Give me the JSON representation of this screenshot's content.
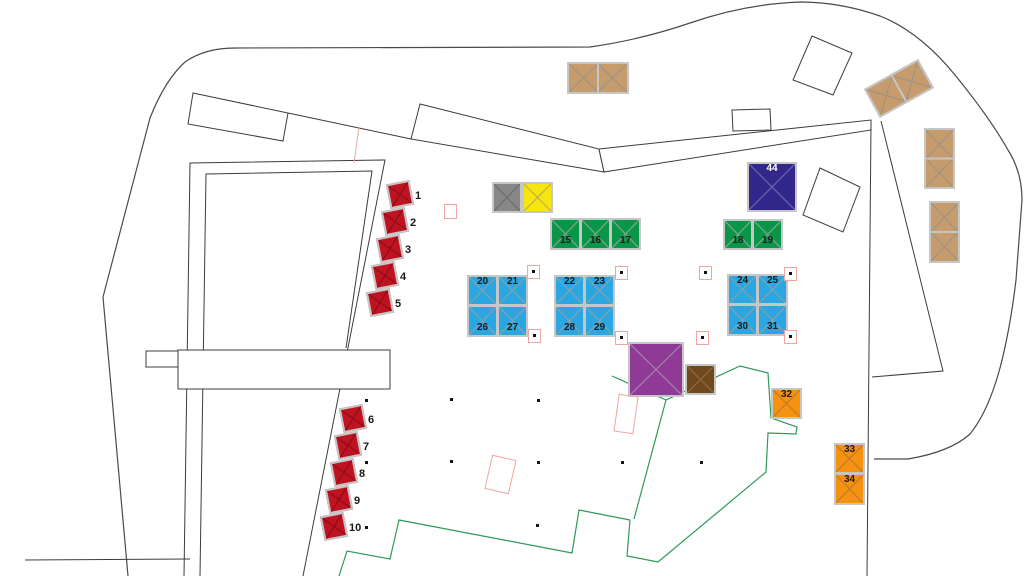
{
  "map": {
    "type": "event-site-plan",
    "visible_numbers": [
      "1",
      "2",
      "3",
      "4",
      "5",
      "6",
      "7",
      "8",
      "9",
      "10",
      "15",
      "16",
      "17",
      "18",
      "19",
      "20",
      "21",
      "22",
      "23",
      "24",
      "25",
      "26",
      "27",
      "28",
      "29",
      "30",
      "31",
      "32",
      "33",
      "34",
      "44"
    ]
  },
  "colors": {
    "red": "#c01321",
    "gray": "#878787",
    "yellow": "#f6e50f",
    "green": "#0a9648",
    "navy": "#32278a",
    "blue": "#2aa6e0",
    "purple": "#8e3a96",
    "brown": "#6f481c",
    "orange": "#f5920f",
    "tan": "#c69c6d",
    "pink_outline": "#efa5a2",
    "site_line": "#4a4a4a",
    "footprint_green": "#2f9958"
  },
  "booths": [
    {
      "id": "red-1",
      "x": 388,
      "y": 182,
      "w": 24,
      "h": 25,
      "rot": -11,
      "fill": "#c01321",
      "xcol": "#8d0e18",
      "outside": "1"
    },
    {
      "id": "red-2",
      "x": 383,
      "y": 209,
      "w": 24,
      "h": 25,
      "rot": -11,
      "fill": "#c01321",
      "xcol": "#8d0e18",
      "outside": "2"
    },
    {
      "id": "red-3",
      "x": 378,
      "y": 236,
      "w": 24,
      "h": 25,
      "rot": -11,
      "fill": "#c01321",
      "xcol": "#8d0e18",
      "outside": "3"
    },
    {
      "id": "red-4",
      "x": 373,
      "y": 263,
      "w": 24,
      "h": 25,
      "rot": -11,
      "fill": "#c01321",
      "xcol": "#8d0e18",
      "outside": "4"
    },
    {
      "id": "red-5",
      "x": 368,
      "y": 290,
      "w": 24,
      "h": 25,
      "rot": -11,
      "fill": "#c01321",
      "xcol": "#8d0e18",
      "outside": "5"
    },
    {
      "id": "red-6",
      "x": 341,
      "y": 406,
      "w": 24,
      "h": 25,
      "rot": -11,
      "fill": "#c01321",
      "xcol": "#8d0e18",
      "outside": "6"
    },
    {
      "id": "red-7",
      "x": 336,
      "y": 433,
      "w": 24,
      "h": 25,
      "rot": -11,
      "fill": "#c01321",
      "xcol": "#8d0e18",
      "outside": "7"
    },
    {
      "id": "red-8",
      "x": 332,
      "y": 460,
      "w": 24,
      "h": 25,
      "rot": -11,
      "fill": "#c01321",
      "xcol": "#8d0e18",
      "outside": "8"
    },
    {
      "id": "red-9",
      "x": 327,
      "y": 487,
      "w": 24,
      "h": 25,
      "rot": -11,
      "fill": "#c01321",
      "xcol": "#8d0e18",
      "outside": "9"
    },
    {
      "id": "red-10",
      "x": 322,
      "y": 514,
      "w": 24,
      "h": 25,
      "rot": -11,
      "fill": "#c01321",
      "xcol": "#8d0e18",
      "outside": "10"
    },
    {
      "id": "gray",
      "x": 492,
      "y": 182,
      "w": 30,
      "h": 31,
      "rot": 0,
      "fill": "#878787",
      "xcol": "#6d6d6d"
    },
    {
      "id": "yellow",
      "x": 522,
      "y": 182,
      "w": 31,
      "h": 31,
      "rot": 0,
      "fill": "#f6e50f",
      "xcol": "#c0b24a"
    },
    {
      "id": "green-15",
      "x": 550,
      "y": 218,
      "w": 31,
      "h": 32,
      "rot": 0,
      "fill": "#0a9648",
      "xcol": "#7aa68d",
      "labels": [
        {
          "t": "15",
          "c": 0,
          "r": 0,
          "v": "bot"
        }
      ]
    },
    {
      "id": "green-16",
      "x": 580,
      "y": 218,
      "w": 31,
      "h": 32,
      "rot": 0,
      "fill": "#0a9648",
      "xcol": "#7aa68d",
      "labels": [
        {
          "t": "16",
          "c": 0,
          "r": 0,
          "v": "bot"
        }
      ]
    },
    {
      "id": "green-17",
      "x": 610,
      "y": 218,
      "w": 31,
      "h": 32,
      "rot": 0,
      "fill": "#0a9648",
      "xcol": "#7aa68d",
      "labels": [
        {
          "t": "17",
          "c": 0,
          "r": 0,
          "v": "bot"
        }
      ]
    },
    {
      "id": "navy-44",
      "x": 747,
      "y": 162,
      "w": 50,
      "h": 50,
      "rot": 0,
      "fill": "#32278a",
      "xcol": "#6a63a8",
      "labels": [
        {
          "t": "44",
          "c": 0,
          "r": 0,
          "v": "top",
          "color": "#ffffff"
        }
      ]
    },
    {
      "id": "green-18",
      "x": 723,
      "y": 219,
      "w": 30,
      "h": 31,
      "rot": 0,
      "fill": "#0a9648",
      "xcol": "#7aa68d",
      "labels": [
        {
          "t": "18",
          "c": 0,
          "r": 0,
          "v": "bot"
        }
      ]
    },
    {
      "id": "green-19",
      "x": 752,
      "y": 219,
      "w": 31,
      "h": 31,
      "rot": 0,
      "fill": "#0a9648",
      "xcol": "#7aa68d",
      "labels": [
        {
          "t": "19",
          "c": 0,
          "r": 0,
          "v": "bot"
        }
      ]
    },
    {
      "id": "blue-20",
      "x": 467,
      "y": 275,
      "w": 31,
      "h": 31,
      "rot": 0,
      "fill": "#2aa6e0",
      "xcol": "#86a0ae",
      "labels": [
        {
          "t": "20",
          "c": 0,
          "r": 0,
          "v": "top"
        }
      ]
    },
    {
      "id": "blue-21",
      "x": 497,
      "y": 275,
      "w": 31,
      "h": 31,
      "rot": 0,
      "fill": "#2aa6e0",
      "xcol": "#86a0ae",
      "labels": [
        {
          "t": "21",
          "c": 0,
          "r": 0,
          "v": "top"
        }
      ]
    },
    {
      "id": "blue-26",
      "x": 467,
      "y": 305,
      "w": 31,
      "h": 32,
      "rot": 0,
      "fill": "#2aa6e0",
      "xcol": "#86a0ae",
      "labels": [
        {
          "t": "26",
          "c": 0,
          "r": 0,
          "v": "bot"
        }
      ]
    },
    {
      "id": "blue-27",
      "x": 497,
      "y": 305,
      "w": 31,
      "h": 32,
      "rot": 0,
      "fill": "#2aa6e0",
      "xcol": "#86a0ae",
      "labels": [
        {
          "t": "27",
          "c": 0,
          "r": 0,
          "v": "bot"
        }
      ]
    },
    {
      "id": "blue-22",
      "x": 554,
      "y": 275,
      "w": 31,
      "h": 31,
      "rot": 0,
      "fill": "#2aa6e0",
      "xcol": "#86a0ae",
      "labels": [
        {
          "t": "22",
          "c": 0,
          "r": 0,
          "v": "top"
        }
      ]
    },
    {
      "id": "blue-23",
      "x": 584,
      "y": 275,
      "w": 31,
      "h": 31,
      "rot": 0,
      "fill": "#2aa6e0",
      "xcol": "#86a0ae",
      "labels": [
        {
          "t": "23",
          "c": 0,
          "r": 0,
          "v": "top"
        }
      ]
    },
    {
      "id": "blue-28",
      "x": 554,
      "y": 305,
      "w": 31,
      "h": 32,
      "rot": 0,
      "fill": "#2aa6e0",
      "xcol": "#86a0ae",
      "labels": [
        {
          "t": "28",
          "c": 0,
          "r": 0,
          "v": "bot"
        }
      ]
    },
    {
      "id": "blue-29",
      "x": 584,
      "y": 305,
      "w": 31,
      "h": 32,
      "rot": 0,
      "fill": "#2aa6e0",
      "xcol": "#86a0ae",
      "labels": [
        {
          "t": "29",
          "c": 0,
          "r": 0,
          "v": "bot"
        }
      ]
    },
    {
      "id": "blue-24",
      "x": 727,
      "y": 274,
      "w": 31,
      "h": 31,
      "rot": 0,
      "fill": "#2aa6e0",
      "xcol": "#86a0ae",
      "labels": [
        {
          "t": "24",
          "c": 0,
          "r": 0,
          "v": "top"
        }
      ]
    },
    {
      "id": "blue-25",
      "x": 757,
      "y": 274,
      "w": 31,
      "h": 31,
      "rot": 0,
      "fill": "#2aa6e0",
      "xcol": "#86a0ae",
      "labels": [
        {
          "t": "25",
          "c": 0,
          "r": 0,
          "v": "top"
        }
      ]
    },
    {
      "id": "blue-30",
      "x": 727,
      "y": 304,
      "w": 31,
      "h": 32,
      "rot": 0,
      "fill": "#2aa6e0",
      "xcol": "#86a0ae",
      "labels": [
        {
          "t": "30",
          "c": 0,
          "r": 0,
          "v": "bot"
        }
      ]
    },
    {
      "id": "blue-31",
      "x": 757,
      "y": 304,
      "w": 31,
      "h": 32,
      "rot": 0,
      "fill": "#2aa6e0",
      "xcol": "#86a0ae",
      "labels": [
        {
          "t": "31",
          "c": 0,
          "r": 0,
          "v": "bot"
        }
      ]
    },
    {
      "id": "purple",
      "x": 628,
      "y": 342,
      "w": 56,
      "h": 55,
      "rot": 0,
      "fill": "#8e3a96",
      "xcol": "#a27fa8"
    },
    {
      "id": "brown",
      "x": 685,
      "y": 364,
      "w": 31,
      "h": 31,
      "rot": 0,
      "fill": "#6f481c",
      "xcol": "#8a6a42"
    },
    {
      "id": "orange-32",
      "x": 771,
      "y": 388,
      "w": 31,
      "h": 31,
      "rot": 0,
      "fill": "#f5920f",
      "xcol": "#c27b2a",
      "labels": [
        {
          "t": "32",
          "c": 0,
          "r": 0,
          "v": "top"
        }
      ]
    },
    {
      "id": "orange-33",
      "x": 834,
      "y": 443,
      "w": 31,
      "h": 31,
      "rot": 0,
      "fill": "#f5920f",
      "xcol": "#c27b2a",
      "labels": [
        {
          "t": "33",
          "c": 0,
          "r": 0,
          "v": "top"
        }
      ]
    },
    {
      "id": "orange-34",
      "x": 834,
      "y": 473,
      "w": 31,
      "h": 32,
      "rot": 0,
      "fill": "#f5920f",
      "xcol": "#c27b2a",
      "labels": [
        {
          "t": "34",
          "c": 0,
          "r": 0,
          "v": "top"
        }
      ]
    },
    {
      "id": "tan-top",
      "x": 567,
      "y": 62,
      "w": 62,
      "h": 32,
      "rot": 0,
      "cols": 2,
      "fill": "#c69c6d",
      "xcol": "#a29384"
    },
    {
      "id": "tan-rot",
      "x": 868,
      "y": 72,
      "w": 62,
      "h": 33,
      "rot": -29,
      "cols": 2,
      "fill": "#c69c6d",
      "xcol": "#a29384"
    },
    {
      "id": "tan-v1",
      "x": 924,
      "y": 128,
      "w": 31,
      "h": 61,
      "rot": 0,
      "rows": 2,
      "fill": "#c69c6d",
      "xcol": "#a29384"
    },
    {
      "id": "tan-v2",
      "x": 929,
      "y": 201,
      "w": 31,
      "h": 62,
      "rot": 0,
      "rows": 2,
      "fill": "#c69c6d",
      "xcol": "#a29384"
    }
  ],
  "pink_corner_markers": [
    [
      527,
      265
    ],
    [
      528,
      329
    ],
    [
      615,
      266
    ],
    [
      615,
      331
    ],
    [
      699,
      266
    ],
    [
      696,
      331
    ],
    [
      784,
      267
    ],
    [
      784,
      330
    ]
  ],
  "asterisk_marks": [
    [
      365,
      399
    ],
    [
      450,
      398
    ],
    [
      537,
      399
    ],
    [
      365,
      461
    ],
    [
      450,
      460
    ],
    [
      537,
      461
    ],
    [
      621,
      461
    ],
    [
      700,
      461
    ],
    [
      365,
      526
    ],
    [
      536,
      524
    ]
  ],
  "pink_empty_rects": [
    {
      "x": 444,
      "y": 204,
      "w": 13,
      "h": 15,
      "rot": 0
    },
    {
      "x": 488,
      "y": 457,
      "w": 25,
      "h": 35,
      "rot": 13
    },
    {
      "x": 616,
      "y": 395,
      "w": 20,
      "h": 38,
      "rot": 8
    }
  ]
}
